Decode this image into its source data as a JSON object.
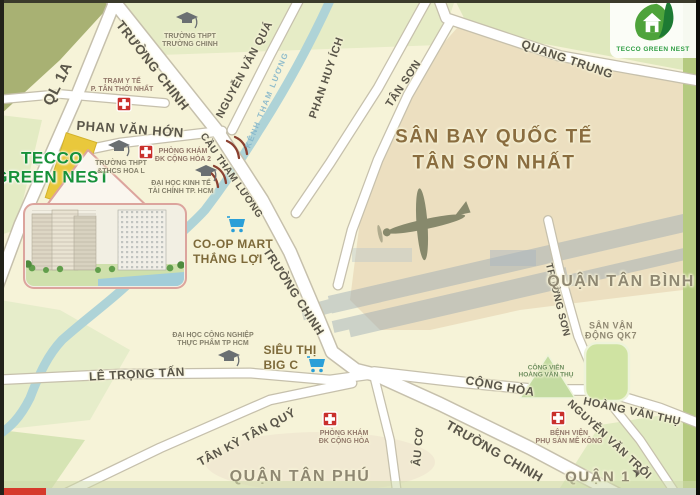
{
  "logo": {
    "text": "TECCO GREEN NEST"
  },
  "project": {
    "line1": "TECCO",
    "line2": "GREEN NEST"
  },
  "airport": {
    "line1": "SÂN BAY QUỐC TẾ",
    "line2": "TÂN SƠN NHẤT"
  },
  "districts": {
    "tan_binh": "QUẬN TÂN BÌNH",
    "tan_phu": "QUẬN TÂN PHÚ",
    "quan1": "QUẬN 1"
  },
  "roads": {
    "ql1a": "QL 1A",
    "truong_chinh_top": "TRƯỜNG CHINH",
    "truong_chinh_mid": "TRƯỜNG CHINH",
    "truong_chinh_bottom": "TRƯỜNG CHINH",
    "nguyen_van_qua": "NGUYỄN VĂN QUÁ",
    "phan_huy_ich": "PHAN HUY ÍCH",
    "tan_son": "TÂN SƠN",
    "quang_trung": "QUANG TRUNG",
    "phan_van_hon": "PHAN VĂN HỚN",
    "cau_tham_luong": "CẦU THAM LƯƠNG",
    "kenh_tham_luong": "KÊNH THAM LƯƠNG",
    "le_trong_tan": "LÊ TRỌNG TẤN",
    "tan_ky_tan_quy": "TÂN KỲ TÂN QUÝ",
    "au_co": "ÂU CƠ",
    "cong_hoa": "CỘNG HÒA",
    "truong_son": "TRƯỜNG SƠN",
    "hoang_van_thu": "HOÀNG VĂN THỤ",
    "nguyen_van_troi": "NGUYỄN VĂN TRỖI"
  },
  "pois": {
    "tram_y_te": {
      "line1": "TRẠM Y TẾ",
      "line2": "P. TÂN THỚI NHẤT"
    },
    "thpt_truong_chinh": {
      "line1": "TRƯỜNG THPT",
      "line2": "TRƯỜNG CHINH"
    },
    "thpt_hoa_lu": {
      "line1": "TRƯỜNG THPT",
      "line2": "&THCS HOA L"
    },
    "pk_cong_hoa_2": {
      "line1": "PHÒNG KHÁM",
      "line2": "ĐK CỘNG HÒA 2"
    },
    "dh_kinh_te": {
      "line1": "ĐẠI HỌC KINH TẾ",
      "line2": "TÀI CHÍNH TP. HCM"
    },
    "coop_mart": {
      "line1": "CO-OP MART",
      "line2": "THẮNG LỢI"
    },
    "dh_cong_nghiep": {
      "line1": "ĐẠI HỌC CÔNG NGHIỆP",
      "line2": "THỰC PHẨM TP HCM"
    },
    "big_c": {
      "line1": "SIÊU THỊ",
      "line2": "BIG C"
    },
    "pk_cong_hoa": {
      "line1": "PHÒNG KHÁM",
      "line2": "ĐK CỘNG HÒA"
    },
    "bv_me_kong": {
      "line1": "BỆNH VIỆN",
      "line2": "PHỤ SẢN MÊ KÔNG"
    },
    "cong_vien_hvt": {
      "line1": "CÔNG VIÊN",
      "line2": "HOÀNG VĂN THỤ"
    },
    "san_van_dong": {
      "line1": "SÂN VẬN",
      "line2": "ĐỘNG QK7"
    }
  },
  "colors": {
    "map_bg": "#f6f3d8",
    "airport_fill": "#ecdfc0",
    "canal_blue": "#aed3d7",
    "site_yellow": "#e9c83c",
    "logo_green": "#2f9e44",
    "project_green": "#17913a",
    "district_text": "#8f8872",
    "progress_red": "#d63a2c",
    "side_strip_green": "#b5ca80"
  }
}
